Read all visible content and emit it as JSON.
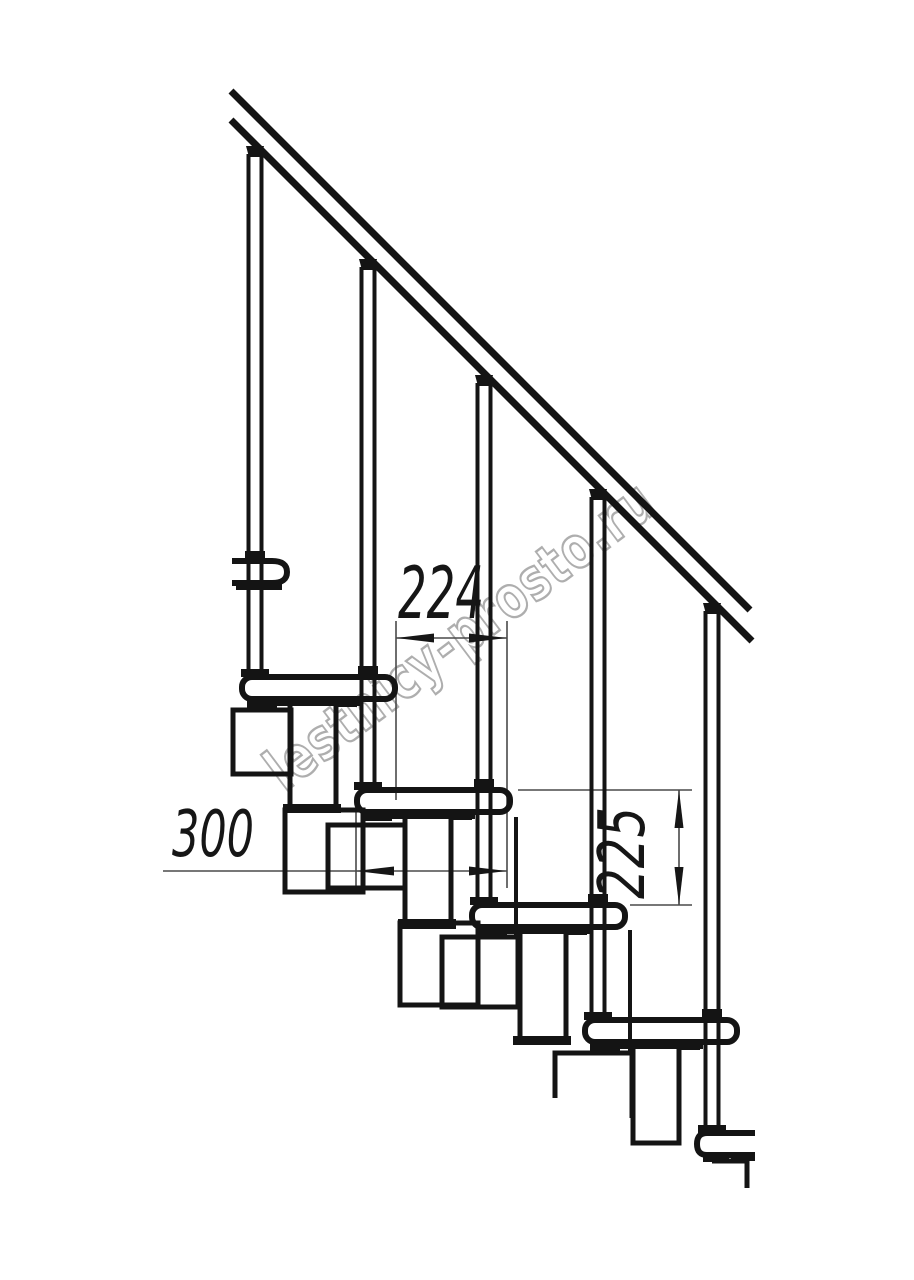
{
  "drawing": {
    "watermark": "lestnicy-prosto.ru",
    "dim_step_run": "224",
    "dim_module_depth": "300",
    "dim_riser": "225",
    "colors": {
      "line": "#141414",
      "dimension": "#4a4a4a",
      "watermark_outline": "#aeaeae",
      "background": "#ffffff"
    }
  }
}
